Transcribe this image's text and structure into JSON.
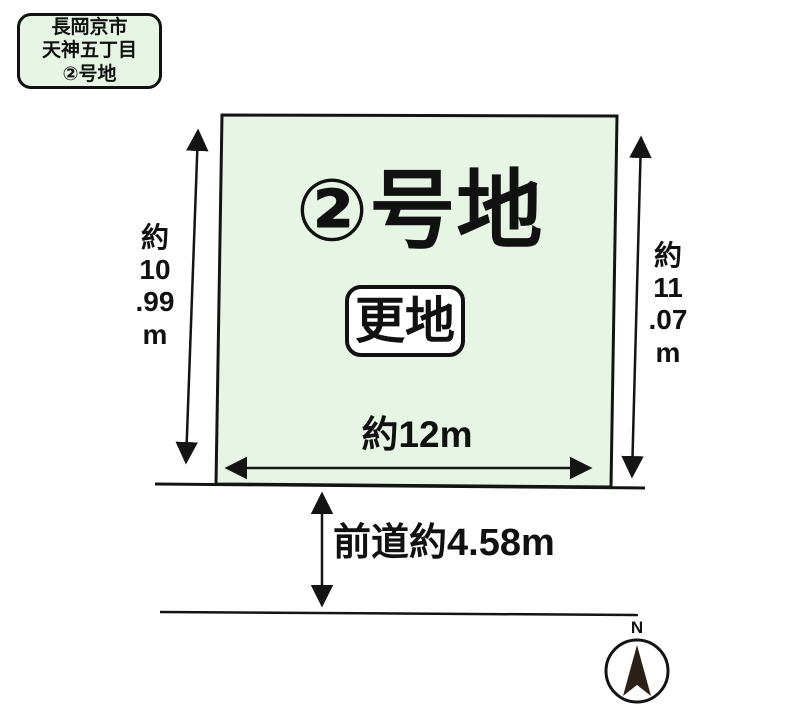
{
  "title": "区画図",
  "location_label": {
    "text": "長岡京市\n天神五丁目\n②号地"
  },
  "plot": {
    "title": "②号地",
    "status_badge": "更地",
    "width_label": "約12m",
    "left_dimension": "約\n10\n.99\nm",
    "right_dimension": "約\n11\n.07\nm"
  },
  "road": {
    "label": "前道約4.58m"
  },
  "compass": {
    "label": "N"
  },
  "colors": {
    "plot_fill": "#e7f5e5",
    "line": "#141414",
    "needle_fill": "#2b2118",
    "badge_fill": "#ffffff",
    "background": "#ffffff"
  }
}
